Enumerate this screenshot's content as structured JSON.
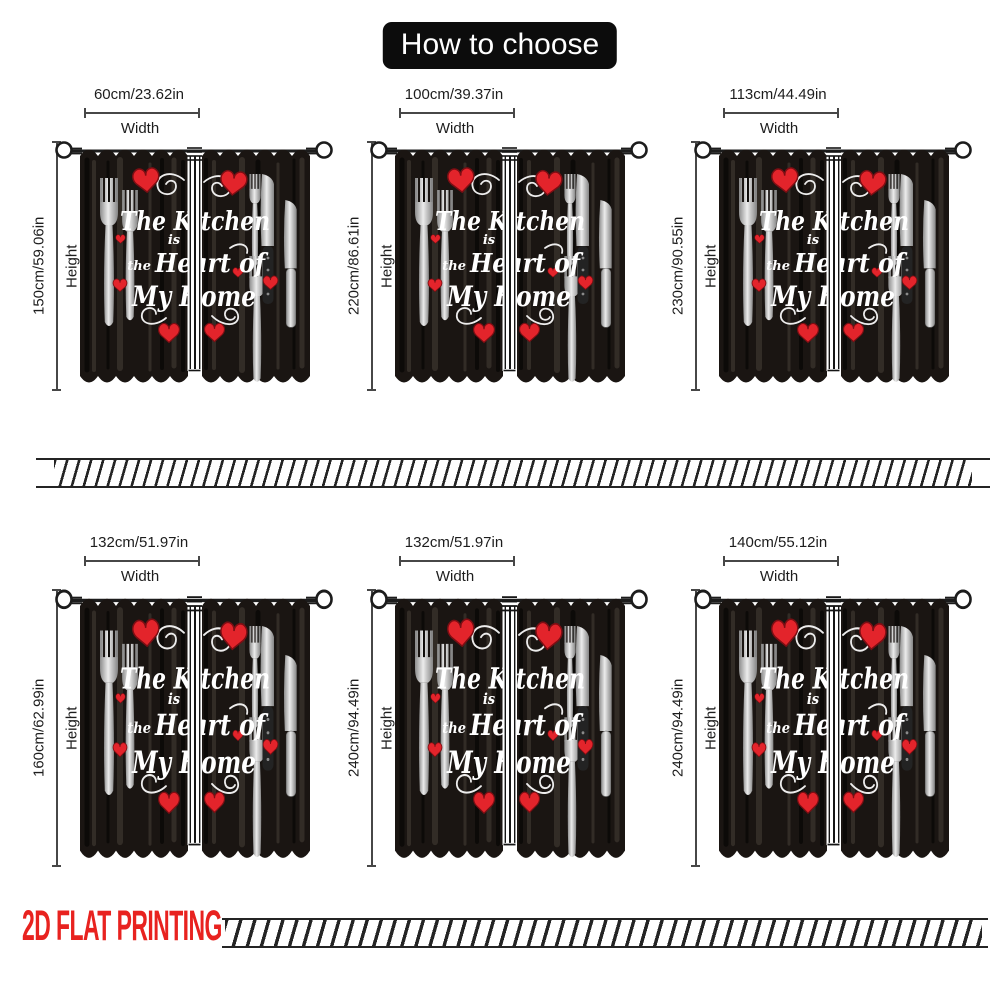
{
  "title": "How to choose",
  "labels": {
    "width": "Width",
    "height": "Height"
  },
  "sizes": [
    {
      "w": "60cm/23.62in",
      "h": "150cm/59.06in"
    },
    {
      "w": "100cm/39.37in",
      "h": "220cm/86.61in"
    },
    {
      "w": "113cm/44.49in",
      "h": "230cm/90.55in"
    },
    {
      "w": "132cm/51.97in",
      "h": "160cm/62.99in"
    },
    {
      "w": "132cm/51.97in",
      "h": "240cm/94.49in"
    },
    {
      "w": "140cm/55.12in",
      "h": "240cm/94.49in"
    }
  ],
  "curtain_text": {
    "line1": "The Kitchen",
    "line2": "is",
    "line3_small": "the",
    "line3": "Heart of",
    "line4": "My Home"
  },
  "footer": {
    "label": "2D FLAT PRINTING"
  },
  "colors": {
    "heart_red": "#e3242b",
    "footer_red": "#e8221f",
    "curtain_black": "#1a1512",
    "dimension_gray": "#474747",
    "title_bg": "#0c0c0c"
  }
}
